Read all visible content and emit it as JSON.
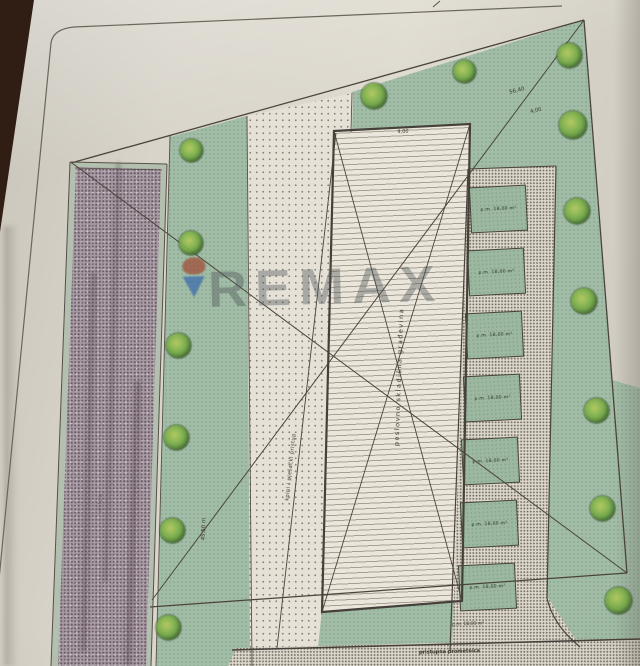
{
  "photo": {
    "background_color": "#301d13",
    "paper_color": "#d8d4ca",
    "description": "photograph of printed architectural site plan"
  },
  "watermark": {
    "text": "REMAX",
    "balloon_top_color": "#a04a33",
    "balloon_bottom_color": "#3c6cab"
  },
  "plan": {
    "colors": {
      "bg": "#301d13",
      "green": "#a2bda7",
      "stall": "#9cb8a1",
      "road": "#a79ba3",
      "stipple_bg": "#e5e1d7",
      "stipple_dot": "#8b8174",
      "path_bg": "#dcd8cd",
      "path_dot": "#7a7064",
      "building": "#eae6db",
      "hatch": "#a89f90",
      "line": "#4a443b",
      "balloon_top": "#a04a33",
      "balloon_bottom": "#3c6cab"
    },
    "building": {
      "label": "poslovno skladišna građevina",
      "top_dimension": "4,00"
    },
    "dimensions": {
      "boundary_length": "56,40",
      "boundary_offset": "4,00",
      "green_strip": "45,50 m"
    },
    "labels": {
      "road": "ulica",
      "access": "kolni i pješački pristup",
      "street": "pristupna prometnica",
      "below_building": "p.m. 18,00 m²"
    },
    "parking": {
      "stall_labels": [
        "p.m. 18,00 m²",
        "p.m. 18,00 m²",
        "p.m. 18,00 m²",
        "p.m. 18,00 m²",
        "p.m. 18,00 m²",
        "p.m. 18,00 m²",
        "p.m. 18,00 m²"
      ]
    },
    "trees": [
      {
        "x": 191,
        "y": 150,
        "d": 23
      },
      {
        "x": 191,
        "y": 243,
        "d": 24
      },
      {
        "x": 178,
        "y": 345,
        "d": 25
      },
      {
        "x": 176,
        "y": 437,
        "d": 25
      },
      {
        "x": 172,
        "y": 530,
        "d": 25
      },
      {
        "x": 168,
        "y": 627,
        "d": 25
      },
      {
        "x": 374,
        "y": 96,
        "d": 26
      },
      {
        "x": 464,
        "y": 71,
        "d": 23
      },
      {
        "x": 569,
        "y": 55,
        "d": 25
      },
      {
        "x": 573,
        "y": 125,
        "d": 28
      },
      {
        "x": 577,
        "y": 211,
        "d": 26
      },
      {
        "x": 584,
        "y": 301,
        "d": 26
      },
      {
        "x": 596,
        "y": 410,
        "d": 25
      },
      {
        "x": 602,
        "y": 508,
        "d": 25
      },
      {
        "x": 618,
        "y": 600,
        "d": 27
      }
    ]
  }
}
